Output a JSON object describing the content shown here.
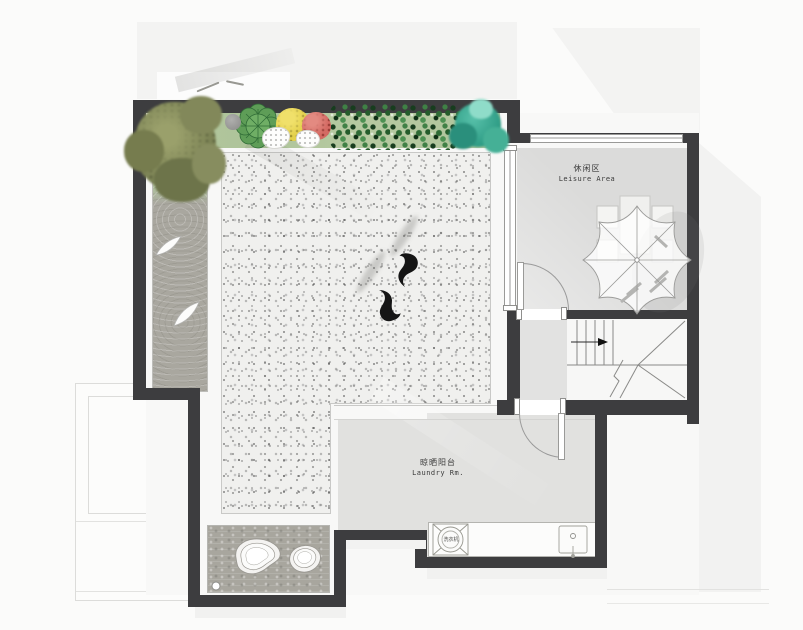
{
  "labels": {
    "leisure": {
      "zh": "休闲区",
      "en": "Leisure Area"
    },
    "laundry": {
      "zh": "晾晒阳台",
      "en": "Laundry Rm."
    },
    "washer": {
      "zh": "洗衣机"
    }
  },
  "colors": {
    "wall": "#3d3d3f",
    "leisure_floor": "#dbdbda",
    "laundry_floor": "#e1e1df",
    "terrace_speckle_base": "#f0f0ee",
    "gravel": "#a9a79f",
    "pebble": "#a8a69e",
    "planting_bed": "#b3c69e",
    "hedge_green": "#2e6b35",
    "shrub_yellow": "#e3d04a",
    "shrub_red": "#d46a63",
    "tree_olive": "#82885a",
    "tree_teal": "#3aa48c",
    "fish": "#151515"
  },
  "symbols": [
    "parasol-with-table-and-chairs",
    "staircase-with-up-arrow",
    "swing-doors",
    "washing-machine",
    "sink",
    "koi-fish-pair",
    "zen-gravel-strip",
    "landscape-stones",
    "planting-bed-with-shrubs",
    "olive-tree",
    "teal-tree"
  ]
}
